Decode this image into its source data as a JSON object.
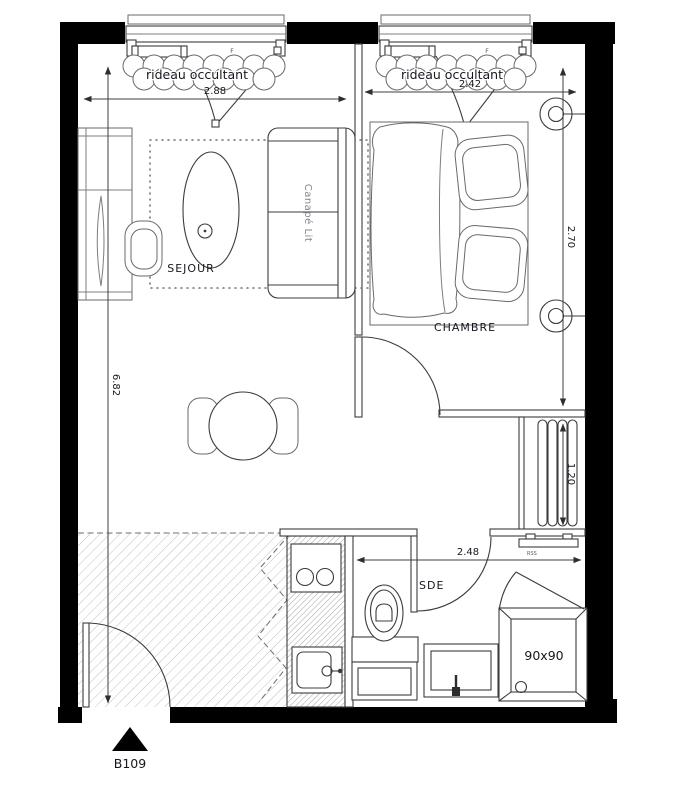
{
  "labels": {
    "curtain_left": "rideau occultant",
    "curtain_right": "rideau occultant",
    "window_left_tag": "F",
    "window_right_tag": "F",
    "sejour": "SEJOUR",
    "chambre": "CHAMBRE",
    "sde": "SDE",
    "sofa_bed": "Canapé Lit",
    "shower_size": "90x90",
    "radiator_shelf": "RSS",
    "unit": "B109"
  },
  "dimensions": {
    "window_left_width": "2.88",
    "window_right_width": "2.42",
    "interior_height": "6.82",
    "chambre_depth": "2.70",
    "radiator_length": "1.20",
    "sde_width": "2.48"
  },
  "colors": {
    "wall": "#000000",
    "line": "#3c3c3c",
    "text": "#16161e"
  }
}
